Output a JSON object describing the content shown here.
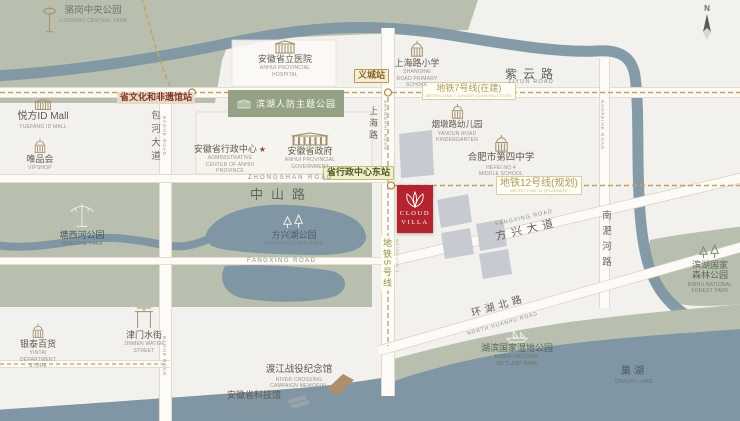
{
  "colors": {
    "background": "#f2f1ed",
    "park_green": "#b8bfae",
    "park_dark_green": "#95a184",
    "water_blue": "#8096a4",
    "road_fill": "#fcfbf8",
    "metro_dash": "#c9a15f",
    "building_gray": "#c7cbd1",
    "marker_red": "#b3242e",
    "icon_brown": "#a5916f"
  },
  "compass": {
    "n": "N"
  },
  "project": {
    "name_line1": "CLOUD",
    "name_line2": "VILLA"
  },
  "metro": {
    "line7_label": "地铁7号线(在建)",
    "line7_sub": "METRO LINE 7 (UNDER CONSTRUCTION)",
    "line12_label": "地铁12号线(规划)",
    "line12_sub": "METRO LINE 12 (PLANNED)",
    "line5_label": "地铁5号线",
    "line5_sub": "METRO LINE 5"
  },
  "stations": {
    "wenhua": "省文化和非遗馆站",
    "yicheng": "义城站",
    "admin_east": "省行政中心东站"
  },
  "roads": {
    "ziyun_zh": "紫云路",
    "ziyun_en": "ZIYUN ROAD",
    "baohe_zh": "包河大道",
    "baohe_en": "BAOHE ROAD",
    "shanghai_zh": "上海路",
    "shanghai_en": "SHANGHAI ROAD",
    "zhongshan_zh": "中山路",
    "zhongshan_en": "ZHONGSHAN ROAD",
    "fangxing_en": "FANGXING ROAD",
    "fangxing_ave_zh": "方兴大道",
    "fangxing_ave_en": "FANGXING ROAD",
    "nanfeihe_zh": "南淝河路",
    "nanfeihe_en": "NANFEIHE ROAD",
    "huanhu_zh": "环湖北路",
    "huanhu_en": "NORTH HUANHU ROAD"
  },
  "pois": {
    "luogang": {
      "zh": "骆岗中央公园",
      "en": "LUOGANG CENTRAL PARK"
    },
    "hospital": {
      "zh": "安徽省立医院",
      "en": "ANHUI PROVINCIAL HOSPITAL"
    },
    "renfang": {
      "zh": "滨湖人防主题公园"
    },
    "shanghai_primary": {
      "zh": "上海路小学",
      "en": "SHANGHAI ROAD PRIMARY SCHOOL"
    },
    "yuefang": {
      "zh": "悦方ID Mall",
      "en": "YUEFANG ID MALL"
    },
    "vipshop": {
      "zh": "唯品会",
      "en": "VIPSHOP"
    },
    "admin_center": {
      "zh": "安徽省行政中心",
      "en": "ADMINISTRATIVE CENTER OF ANHUI PROVINCE"
    },
    "gov": {
      "zh": "安徽省政府",
      "en": "ANHUI PROVINCIAL GOVERNMENT"
    },
    "kindergarten": {
      "zh": "烟墩路幼儿园",
      "en": "YANDUN ROAD KINDERGARTEN"
    },
    "no4_school": {
      "zh": "合肥市第四中学",
      "en": "HEFEI NO.4 MIDDLE SCHOOL"
    },
    "tangxihe": {
      "zh": "塘西河公园",
      "en": "TANGXIHE PARK"
    },
    "fangxinghu": {
      "zh": "方兴湖公园",
      "en": "FANGXING LAKE PARK"
    },
    "forest": {
      "zh": "滨湖国家森林公园",
      "en": "BINHU NATIONAL FOREST PARK"
    },
    "wetland": {
      "zh": "湖滨国家湿地公园",
      "en": "HUBIN NATIONAL WETLAND PARK"
    },
    "chaohu": {
      "zh": "巢湖",
      "en": "CHAOHU LAKE"
    },
    "yintai": {
      "zh": "银泰百货",
      "en": "YINTAI DEPARTMENT STORE"
    },
    "jinmen": {
      "zh": "津门水街",
      "en": "JINMEN WATER STREET"
    },
    "dujiang": {
      "zh": "渡江战役纪念馆",
      "en": "RIVER CROSSING CAMPAIGN MEMORIAL HALL"
    },
    "science": {
      "zh": "安徽省科技馆",
      "en": "ANHUI SCIENCE AND TECHNOLOGY MUSEUM"
    }
  }
}
